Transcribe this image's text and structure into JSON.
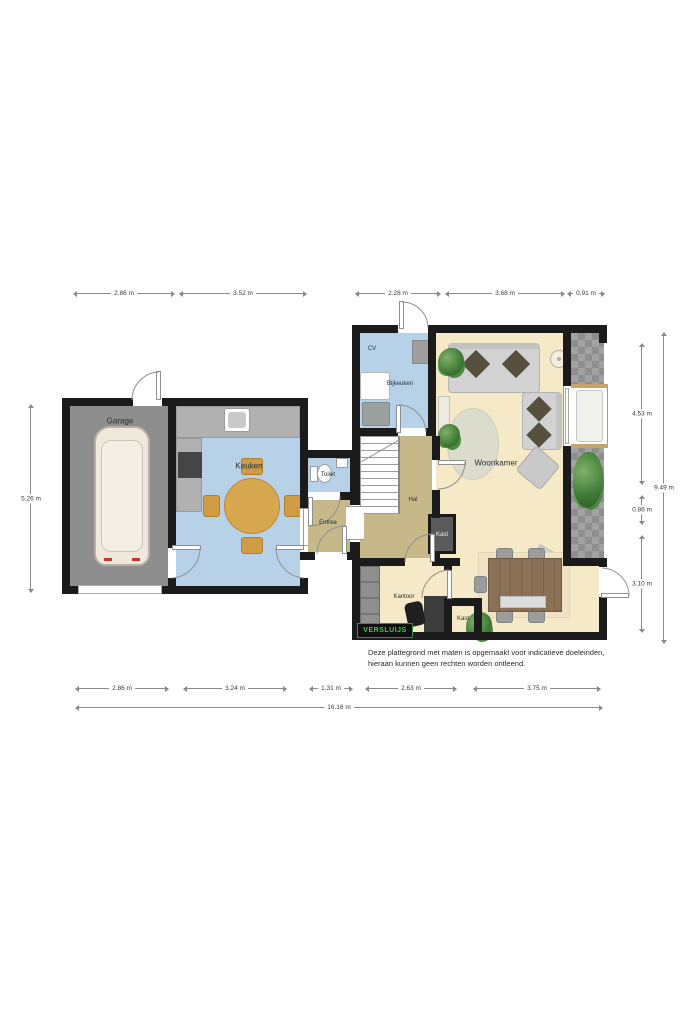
{
  "logo": {
    "text": "VERSLUIJS"
  },
  "disclaimer": {
    "line1": "Deze plattegrond met maten is opgemaakt voor indicatieve doeleinden,",
    "line2": "hieraan kunnen geen rechten worden ontleend."
  },
  "rooms": {
    "garage": "Garage",
    "keuken": "Keuken",
    "toilet": "Toilet",
    "entree": "Entree",
    "hal": "Hal",
    "cv": "CV",
    "bijkeuken": "Bijkeuken",
    "woonkamer": "Woonkamer",
    "kantoor": "Kantoor",
    "kast_hal": "Kast",
    "kast_kantoor": "Kast"
  },
  "dimensions": {
    "top": [
      "2.86 m",
      "3.52 m",
      "2.28 m",
      "3.68 m",
      "0.91 m"
    ],
    "bottom": [
      "2.86 m",
      "3.24 m",
      "1.31 m",
      "2.63 m",
      "3.75 m"
    ],
    "bottom_total": "16.16 m",
    "left": "5.26 m",
    "right": [
      "4.53 m",
      "0.86 m",
      "3.10 m"
    ],
    "right_total": "9.49 m"
  },
  "colors": {
    "wall": "#1b1b1b",
    "garage_floor": "#8e8e8e",
    "wet_room_floor": "#b7d2e8",
    "living_floor": "#f6e9c8",
    "hall_floor": "#c7b88a",
    "terrace_stone": "#a2a2a2",
    "logo_green": "#45c94f"
  }
}
